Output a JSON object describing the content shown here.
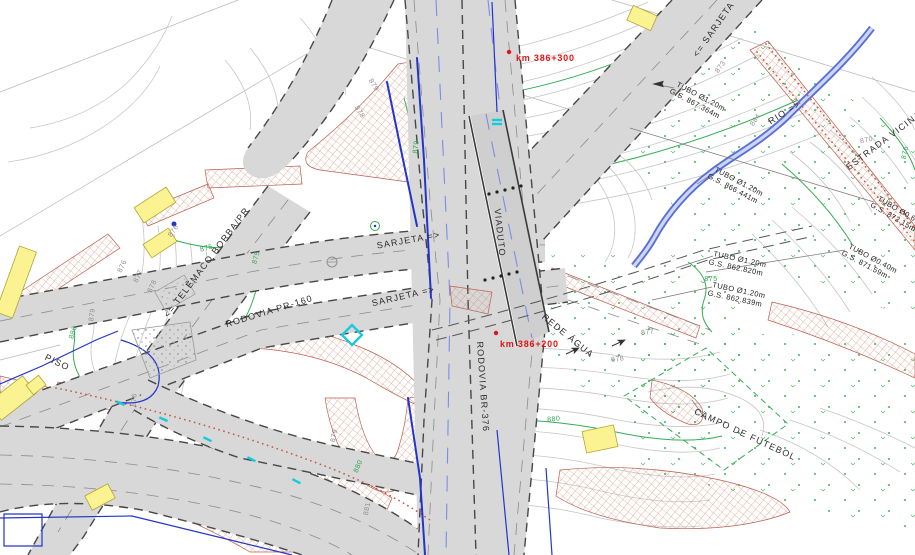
{
  "drawing": {
    "type": "road-interchange-plan",
    "colors": {
      "station_red": "#e41313",
      "index_contour_green": "#2fa551",
      "water_blue": "#2334cc",
      "slope_hatch_red": "#bb5f4e",
      "building_yellow": "#fbf392",
      "road_gray": "#d8d8d8",
      "cyan_marker": "#17c9dc"
    }
  },
  "labels": {
    "station_300": "km  386+300",
    "station_200": "km  386+200",
    "sarjeta_1": "SARJETA  =>",
    "sarjeta_2": "SARJETA  =>",
    "sarjeta_3": "<=  SARJETA",
    "viaduto": "VIADUTO",
    "rodovia_pr160": "RODOVIA  PR-160",
    "rodovia_br376": "RODOVIA  BR-376",
    "telemaco": "<=  TELÊMACO  BORBA/PR",
    "rede_agua": "REDE  ÁGUA",
    "estrada_vicinal": "ESTRADA  VICINAL",
    "rio": "RIO  =>",
    "campo_futebol": "CAMPO  DE  FUTEBOL",
    "piso": "PISO"
  },
  "culverts": [
    {
      "size": "TUBO  Ø1.20m",
      "gs": "G.S.  867.364m"
    },
    {
      "size": "TUBO  Ø1.20m",
      "gs": "G.S.  866.441m"
    },
    {
      "size": "TUBO  Ø1.20m",
      "gs": "G.S.  862.820m"
    },
    {
      "size": "TUBO  Ø1.20m",
      "gs": "G.S.  862.839m"
    },
    {
      "size": "TUBO  Ø0.60m",
      "gs": "G.S.  872.15m"
    },
    {
      "size": "TUBO  Ø0.40m",
      "gs": "G.S.  871.59m"
    }
  ],
  "contour_labels": [
    "873",
    "884",
    "876",
    "875",
    "875",
    "876",
    "877",
    "878",
    "879",
    "880",
    "876",
    "879",
    "880",
    "881",
    "877",
    "878",
    "880",
    "879",
    "878",
    "879",
    "875",
    "876",
    "870"
  ]
}
